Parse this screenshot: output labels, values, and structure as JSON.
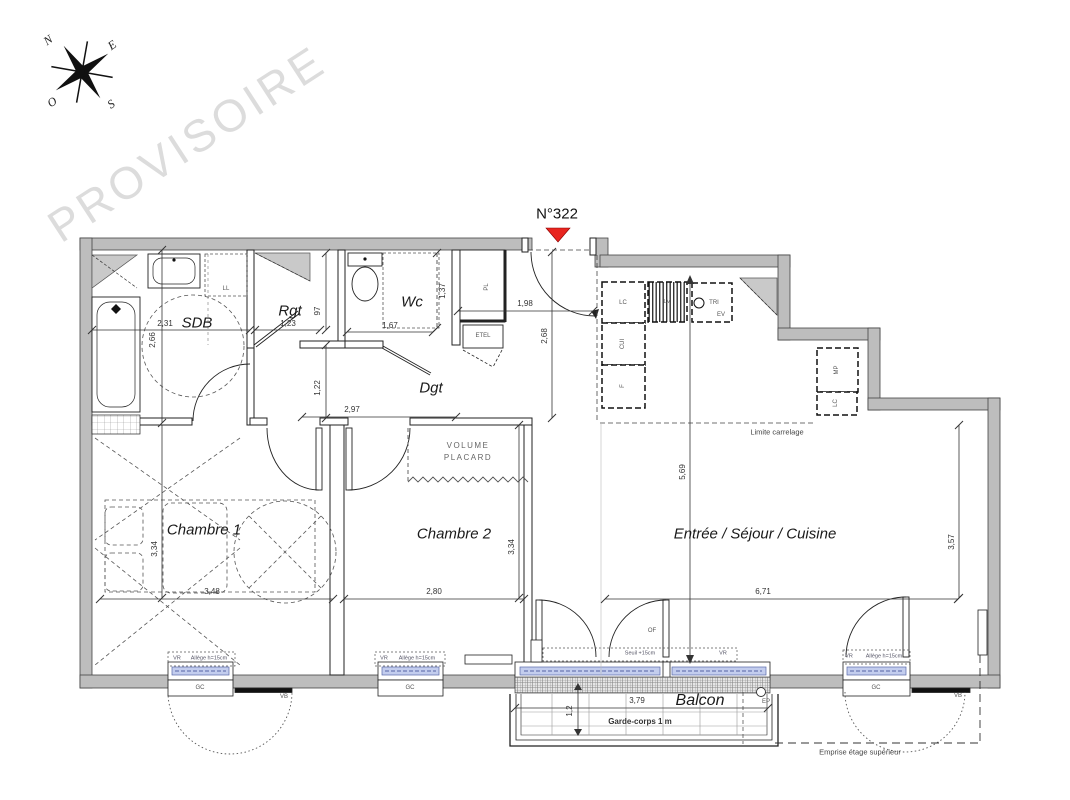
{
  "watermark": "PROVISOIRE",
  "apartment_number": "N°322",
  "compass": {
    "north": "N",
    "east": "E",
    "west": "O",
    "south": "S"
  },
  "rooms": {
    "sdb": "SDB",
    "rgt": "Rgt",
    "wc": "Wc",
    "dgt": "Dgt",
    "chambre1": "Chambre 1",
    "chambre2": "Chambre 2",
    "sejour": "Entrée / Séjour / Cuisine",
    "balcon": "Balcon"
  },
  "dimensions": {
    "sdb_width": "2,31",
    "sdb_height": "2,66",
    "rgt_width": "1,23",
    "rgt_depth": "97",
    "wc_width": "1,67",
    "wc_depth": "1,37",
    "dgt_width": "2,97",
    "dgt_height": "1,22",
    "entry_width": "1,98",
    "entry_height": "2,68",
    "sejour_height": "5,69",
    "sejour_width": "6,71",
    "sejour_right_height": "3,57",
    "chambre1_width": "3,48",
    "chambre1_height": "3,34",
    "chambre2_width": "2,80",
    "chambre2_height": "3,34",
    "balcon_width": "3,79",
    "balcon_depth": "1,2"
  },
  "annotations": {
    "volume_placard_line1": "VOLUME",
    "volume_placard_line2": "PLACARD",
    "limite_carrelage": "Limite carrelage",
    "garde_corps": "Garde-corps 1 m",
    "emprise": "Emprise étage supérieur",
    "allege": "Allège h=15cm",
    "seuil": "Seuil +15cm",
    "vr": "VR",
    "vb": "VB",
    "gc": "GC",
    "of": "OF",
    "ep": "EP"
  },
  "fixtures": {
    "ll": "LL",
    "pl": "PL",
    "etel": "ETEL",
    "lc": "LC",
    "cui": "CUI",
    "f": "F",
    "lv": "LV",
    "tri": "TRI",
    "ev": "EV",
    "mp": "MP",
    "lc2": "LC"
  },
  "colors": {
    "wall": "#bdbdbd",
    "accent_red": "#e8251f",
    "glazing": "#c3cdee",
    "watermark": "#dcdcdc"
  }
}
